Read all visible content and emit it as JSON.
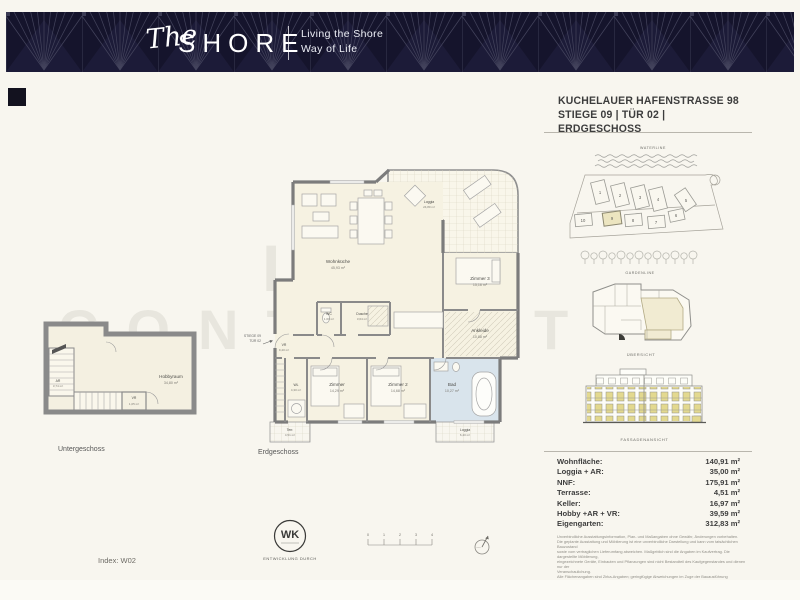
{
  "header": {
    "logo_script": "The",
    "logo_main": "SHORE",
    "tagline_line1": "Living the Shore",
    "tagline_line2": "Way of Life"
  },
  "title": {
    "line1": "KUCHELAUER HAFENSTRASSE 98",
    "line2": "STIEGE 09 | TÜR 02 | ERDGESCHOSS"
  },
  "sidebar": {
    "waterline_label": "WATERLINE",
    "gardenline_label": "GARDENLINE",
    "overview_caption": "ÜBERSICHT",
    "facade_caption": "FASSADENANSICHT",
    "siteplan_numbers": [
      "1",
      "2",
      "3",
      "4",
      "5",
      "6",
      "7",
      "8",
      "9",
      "10"
    ],
    "highlighted_building": "9"
  },
  "plans": {
    "eg": {
      "caption": "Erdgeschoss",
      "entry_line1": "STIEGE 09",
      "entry_line2": "TÜR 02",
      "rooms": {
        "wohnkueche": {
          "name": "Wohnküche",
          "area": "45,93 m²"
        },
        "loggia_top": {
          "name": "Loggia",
          "area": "24,80 m²"
        },
        "zimmer3": {
          "name": "Zimmer 3",
          "area": "15,16 m²"
        },
        "ankleide": {
          "name": "Ankleide",
          "area": "10,88 m²"
        },
        "wc": {
          "name": "WC",
          "area": "1,60 m²"
        },
        "dusche": {
          "name": "Dusche",
          "area": "3,64 m²"
        },
        "vr": {
          "name": "VR",
          "area": "9,40 m²"
        },
        "wl": {
          "name": "WL",
          "area": "4,30 m²"
        },
        "zimmer": {
          "name": "Zimmer",
          "area": "14,29 m²"
        },
        "zimmer2": {
          "name": "Zimmer 2",
          "area": "14,68 m²"
        },
        "bad": {
          "name": "Bad",
          "area": "10,27 m²"
        },
        "terrasse": {
          "name": "Terr.",
          "area": "4,51 m²"
        },
        "loggia_bottom": {
          "name": "Loggia",
          "area": "6,40 m²"
        }
      }
    },
    "ug": {
      "caption": "Untergeschoss",
      "rooms": {
        "hobbyraum": {
          "name": "Hobbyraum",
          "area": "34,80 m²"
        },
        "ar": {
          "name": "AR",
          "area": "3,74 m²"
        },
        "vr": {
          "name": "VR",
          "area": "1,05 m²"
        }
      }
    }
  },
  "areas": {
    "rows": [
      {
        "label": "Wohnfläche:",
        "value": "140,91 m²"
      },
      {
        "label": "Loggia + AR:",
        "value": "35,00 m²"
      },
      {
        "label": "NNF:",
        "value": "175,91 m²"
      },
      {
        "label": "Terrasse:",
        "value": "4,51 m²"
      },
      {
        "label": "Keller:",
        "value": "16,97 m²"
      },
      {
        "label": "Hobby +AR + VR:",
        "value": "39,59 m²"
      },
      {
        "label": "Eigengarten:",
        "value": "312,83 m²"
      }
    ]
  },
  "disclaimer": {
    "lines": [
      "Unverbindliche Ausstattungsinformation, Plan- und Maßangaben ohne Gewähr, Änderungen vorbehalten.",
      "Die geplante Ausstattung und Möblierung ist eine unverbindliche Darstellung und kann vom tatsächlichen Bauzustand",
      "sowie vom vertraglichen Lieferumfang abweichen. Maßgeblich sind die Angaben im Kaufvertrag. Die dargestellte Möblierung,",
      "eingezeichnete Geräte, Einbauten und Pflanzungen sind nicht Bestandteil des Kaufgegenstandes und dienen nur der",
      "Veranschaulichung.",
      "Alle Flächenangaben sind Zirka-Angaben; geringfügige Abweichungen im Zuge der Bauausführung begründen keine Ansprüche",
      "oder Mängelrüge."
    ]
  },
  "footer": {
    "index_label": "Index: W02",
    "logo_initials": "WK",
    "development_label": "ENTWICKLUNG DURCH",
    "scale_ticks": [
      "0",
      "1",
      "2",
      "3",
      "4"
    ]
  },
  "watermark": {
    "line1": "IMMO",
    "line2": "CONTRACT"
  },
  "colors": {
    "brand_navy": "#15142c",
    "highlight_yellow": "#ece5c0",
    "facade_window_yellow": "#e3d98f",
    "bath_blue": "#d9e4ec",
    "background_cream": "#f8f6ef"
  }
}
